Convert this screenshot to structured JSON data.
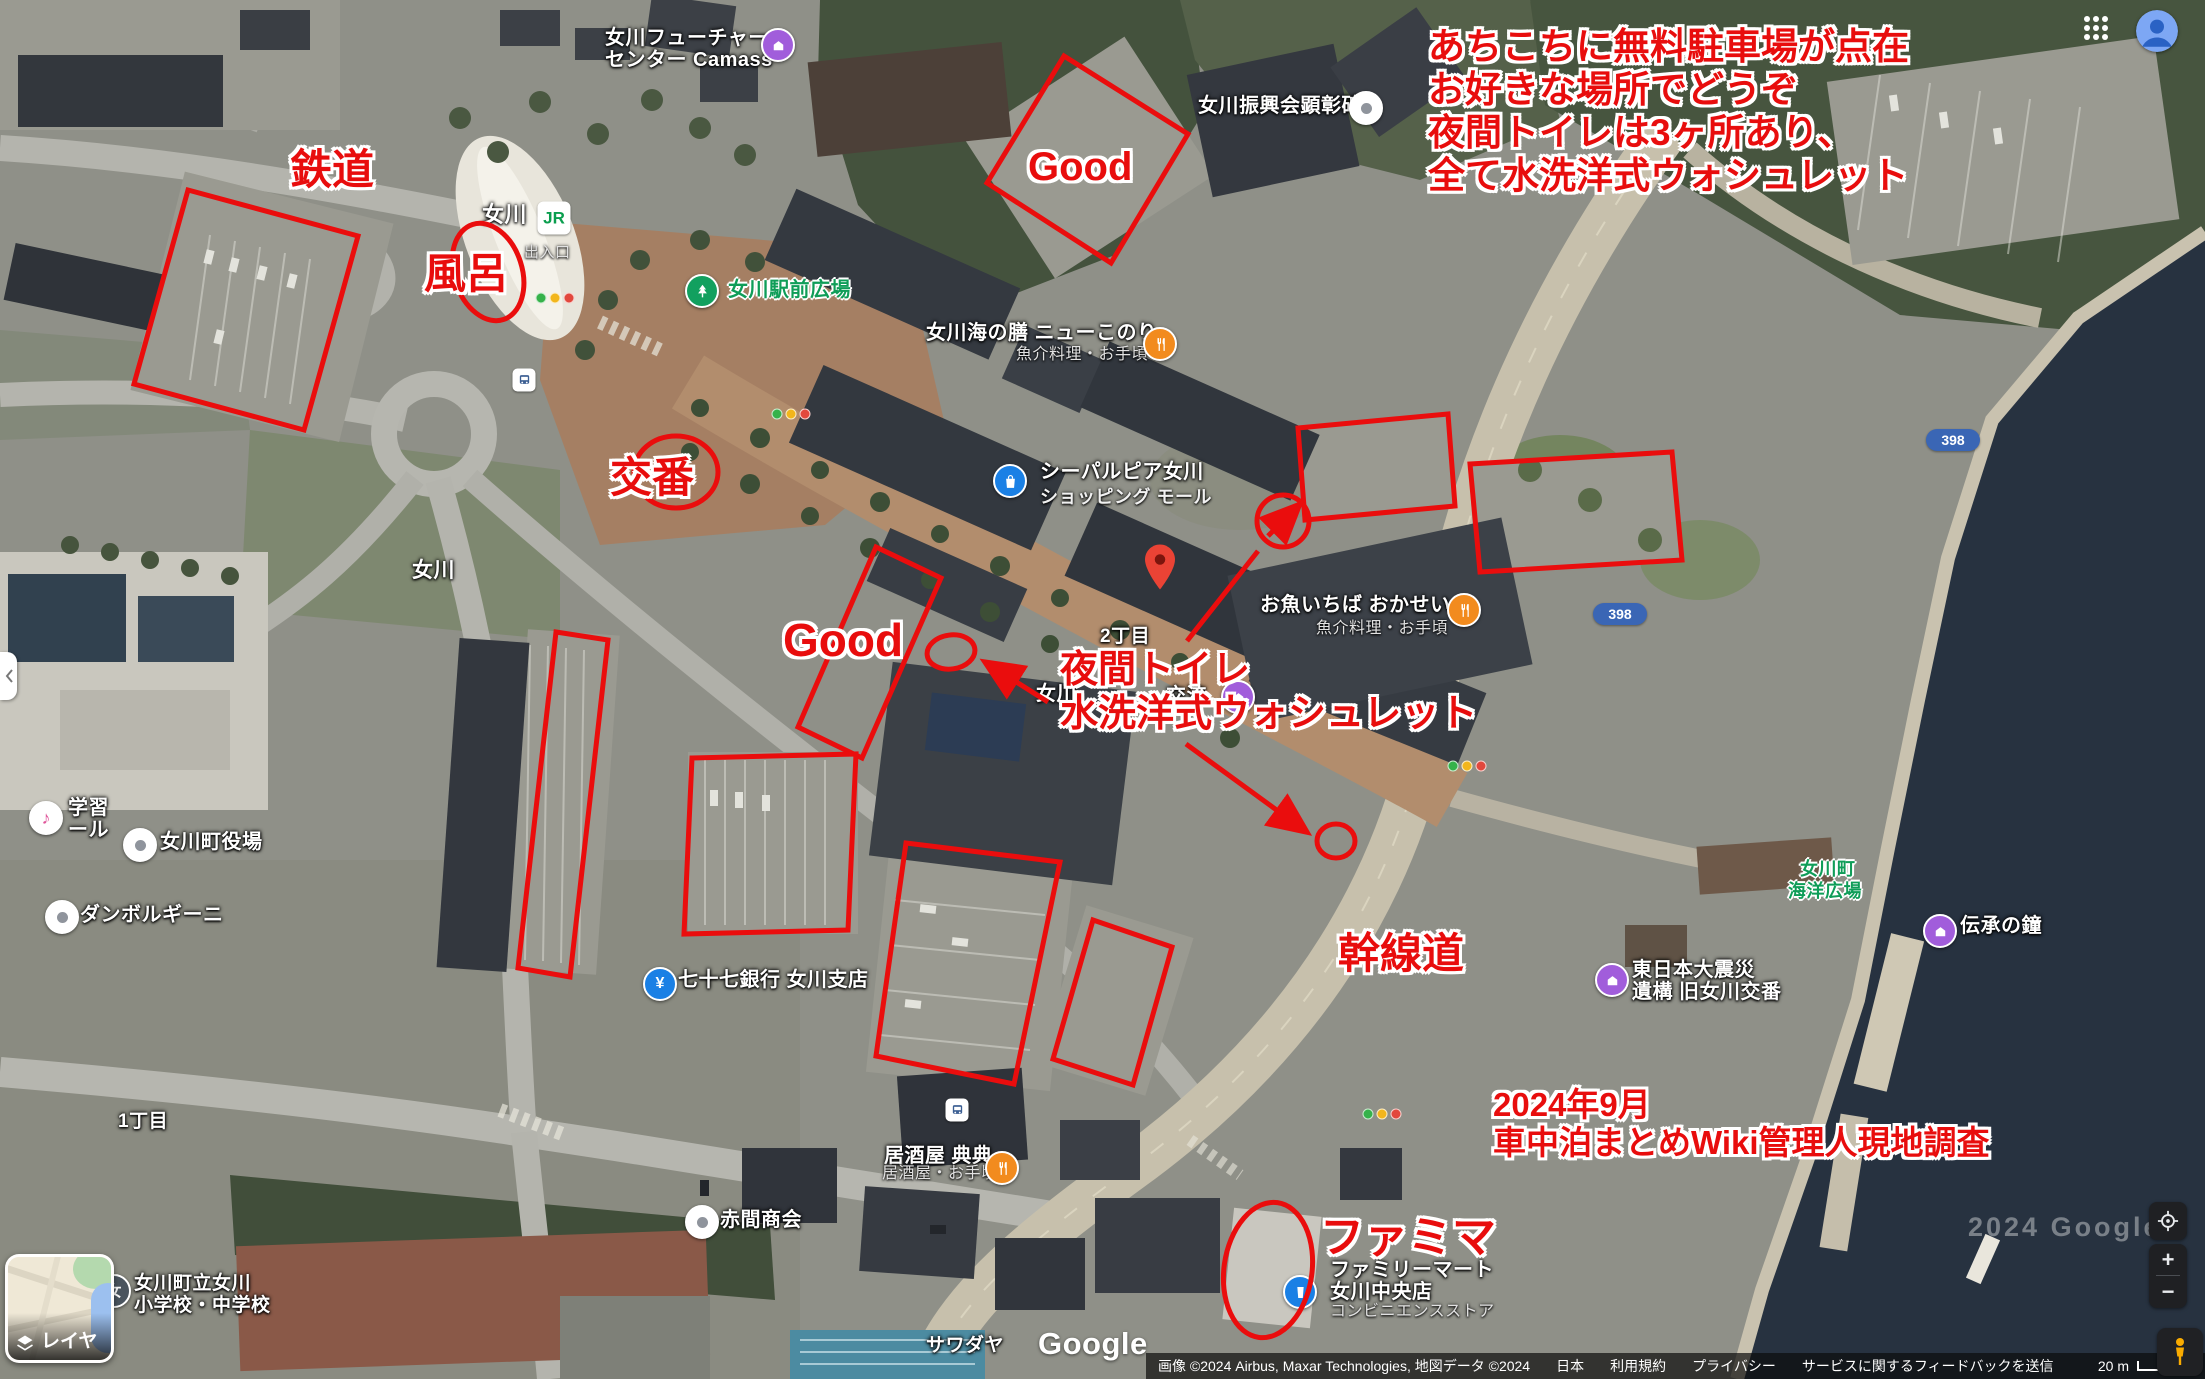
{
  "ui": {
    "layers_button": {
      "label": "レイヤ"
    },
    "controls": {
      "zoom_in": "+",
      "zoom_out": "−"
    },
    "google_logo": "Google",
    "watermark": "2024 Google",
    "attribution": {
      "imagery": "画像 ©2024 Airbus, Maxar Technologies, 地図データ ©2024",
      "links": [
        "日本",
        "利用規約",
        "プライバシー",
        "サービスに関するフィードバックを送信"
      ],
      "scale": "20 m"
    }
  },
  "map": {
    "labels": [
      {
        "t": "女川フューチャー",
        "x": 605,
        "y": 28,
        "c": "w",
        "n": "label-onagawa-future-center"
      },
      {
        "t": "センター Camass",
        "x": 605,
        "y": 50,
        "c": "w",
        "n": "label-onagawa-future-center-2"
      },
      {
        "t": "女川振興会顕彰碑",
        "x": 1198,
        "y": 96,
        "c": "w",
        "n": "label-shinkokai-monument"
      },
      {
        "t": "女川",
        "x": 482,
        "y": 203,
        "c": "w",
        "z": 22,
        "n": "label-onagawa-station"
      },
      {
        "t": "出入口",
        "x": 524,
        "y": 245,
        "c": "sub",
        "z": 15,
        "n": "label-station-entrance"
      },
      {
        "t": "女川駅前広場",
        "x": 728,
        "y": 280,
        "c": "green",
        "n": "label-ekimae-hiroba"
      },
      {
        "t": "女川海の膳 ニューこのり",
        "x": 926,
        "y": 323,
        "c": "w",
        "n": "label-new-konori"
      },
      {
        "t": "魚介料理・お手頃",
        "x": 1016,
        "y": 347,
        "c": "sub",
        "n": "label-new-konori-sub"
      },
      {
        "t": "シーパルピア女川",
        "x": 1040,
        "y": 462,
        "c": "w",
        "n": "label-seapal-pier"
      },
      {
        "t": "ショッピング モール",
        "x": 1040,
        "y": 488,
        "c": "w2",
        "n": "label-seapal-pier-sub"
      },
      {
        "t": "お魚いちば おかせい",
        "x": 1260,
        "y": 595,
        "c": "w",
        "n": "label-okasei"
      },
      {
        "t": "魚介料理・お手頃",
        "x": 1316,
        "y": 621,
        "c": "sub",
        "n": "label-okasei-sub"
      },
      {
        "t": "2丁目",
        "x": 1100,
        "y": 627,
        "c": "w",
        "z": 19,
        "n": "label-2chome"
      },
      {
        "t": "女川",
        "x": 412,
        "y": 560,
        "c": "w",
        "z": 21,
        "n": "label-onagawa-area"
      },
      {
        "t": "1丁目",
        "x": 118,
        "y": 1112,
        "c": "w",
        "z": 19,
        "n": "label-1chome"
      },
      {
        "t": "女川町役場",
        "x": 160,
        "y": 832,
        "c": "w",
        "n": "label-town-hall"
      },
      {
        "t": "ダンボルギーニ",
        "x": 80,
        "y": 905,
        "c": "w",
        "n": "label-danborghini"
      },
      {
        "t": "学習",
        "x": 68,
        "y": 798,
        "c": "w",
        "n": "label-gakushu-partial"
      },
      {
        "t": "ール",
        "x": 68,
        "y": 820,
        "c": "w",
        "n": "label-hall-partial"
      },
      {
        "t": "七十七銀行 女川支店",
        "x": 678,
        "y": 970,
        "c": "w",
        "n": "label-77bank"
      },
      {
        "t": "赤間商会",
        "x": 720,
        "y": 1210,
        "c": "w",
        "n": "label-akama-shokai"
      },
      {
        "t": "居酒屋 典典",
        "x": 884,
        "y": 1146,
        "c": "w",
        "n": "label-izakaya-tenten"
      },
      {
        "t": "居酒屋・お手頃",
        "x": 882,
        "y": 1166,
        "c": "sub",
        "n": "label-izakaya-sub"
      },
      {
        "t": "サワダヤ",
        "x": 926,
        "y": 1336,
        "c": "w",
        "z": 19,
        "n": "label-sawadaya"
      },
      {
        "t": "ファミリーマート",
        "x": 1330,
        "y": 1260,
        "c": "w",
        "n": "label-familymart"
      },
      {
        "t": "女川中央店",
        "x": 1330,
        "y": 1282,
        "c": "w",
        "n": "label-familymart-2"
      },
      {
        "t": "コンビニエンスストア",
        "x": 1330,
        "y": 1304,
        "c": "sub",
        "n": "label-familymart-sub"
      },
      {
        "t": "東日本大震災",
        "x": 1632,
        "y": 960,
        "c": "w",
        "n": "label-shinsai-ikou"
      },
      {
        "t": "遺構 旧女川交番",
        "x": 1632,
        "y": 982,
        "c": "w",
        "n": "label-shinsai-ikou-2"
      },
      {
        "t": "女川町",
        "x": 1800,
        "y": 860,
        "c": "green",
        "z": 18,
        "n": "label-kaiyo-hiroba"
      },
      {
        "t": "海洋広場",
        "x": 1788,
        "y": 882,
        "c": "green",
        "z": 18,
        "n": "label-kaiyo-hiroba-2"
      },
      {
        "t": "伝承の鐘",
        "x": 1960,
        "y": 916,
        "c": "w",
        "n": "label-densho-no-kane"
      },
      {
        "t": "女川",
        "x": 1036,
        "y": 684,
        "c": "w",
        "n": "label-koryukan-partial-1"
      },
      {
        "t": "交流",
        "x": 1166,
        "y": 686,
        "c": "w",
        "n": "label-koryukan-partial-2"
      },
      {
        "t": "女川町立女川",
        "x": 134,
        "y": 1274,
        "c": "w",
        "z": 19,
        "n": "label-school"
      },
      {
        "t": "小学校・中学校",
        "x": 134,
        "y": 1296,
        "c": "w",
        "z": 19,
        "n": "label-school-2"
      }
    ],
    "pins": [
      {
        "k": "purple",
        "x": 778,
        "y": 45,
        "n": "camass-pin"
      },
      {
        "k": "poi",
        "x": 1366,
        "y": 108,
        "n": "monument-pin"
      },
      {
        "k": "jr",
        "t": "JR",
        "x": 554,
        "y": 218,
        "n": "jr-station-logo"
      },
      {
        "k": "park",
        "x": 702,
        "y": 291,
        "n": "ekimae-hiroba-pin"
      },
      {
        "k": "food",
        "x": 1160,
        "y": 344,
        "n": "new-konori-pin"
      },
      {
        "k": "shopping",
        "x": 1010,
        "y": 481,
        "n": "seapal-pier-pin"
      },
      {
        "k": "red-marker",
        "x": 1160,
        "y": 572,
        "n": "dropped-pin"
      },
      {
        "k": "food",
        "x": 1464,
        "y": 610,
        "n": "okasei-pin"
      },
      {
        "k": "purple",
        "x": 1238,
        "y": 697,
        "n": "koryukan-pin"
      },
      {
        "k": "poi",
        "x": 140,
        "y": 845,
        "n": "town-hall-pin"
      },
      {
        "k": "music",
        "t": "♪",
        "x": 46,
        "y": 818,
        "n": "hall-pin"
      },
      {
        "k": "poi",
        "x": 62,
        "y": 917,
        "n": "danborghini-pin"
      },
      {
        "k": "bank",
        "t": "¥",
        "x": 660,
        "y": 984,
        "n": "77bank-pin"
      },
      {
        "k": "poi",
        "x": 702,
        "y": 1222,
        "n": "akama-pin"
      },
      {
        "k": "food",
        "x": 1002,
        "y": 1168,
        "n": "tenten-pin"
      },
      {
        "k": "conv",
        "x": 1300,
        "y": 1292,
        "n": "familymart-pin"
      },
      {
        "k": "school",
        "t": "女",
        "x": 114,
        "y": 1291,
        "n": "school-pin"
      },
      {
        "k": "purple",
        "x": 1612,
        "y": 980,
        "n": "ikou-pin"
      },
      {
        "k": "purple",
        "x": 1940,
        "y": 931,
        "n": "bell-pin"
      },
      {
        "k": "bus",
        "x": 524,
        "y": 380,
        "n": "bus-stop-pin"
      },
      {
        "k": "bus",
        "x": 957,
        "y": 1110,
        "n": "bus-stop-pin-2"
      },
      {
        "k": "traffic",
        "x": 791,
        "y": 414,
        "n": "traffic-light"
      },
      {
        "k": "traffic",
        "x": 1467,
        "y": 766,
        "n": "traffic-light-2"
      },
      {
        "k": "traffic",
        "x": 1382,
        "y": 1114,
        "n": "traffic-light-3"
      },
      {
        "k": "traffic",
        "x": 555,
        "y": 298,
        "n": "traffic-light-4"
      }
    ],
    "badges": [
      {
        "t": "398",
        "x": 1953,
        "y": 440,
        "n": "route-398-badge"
      },
      {
        "t": "398",
        "x": 1620,
        "y": 614,
        "n": "route-398-badge-2"
      }
    ]
  },
  "annotations": {
    "texts": [
      {
        "n": "note-parking-info",
        "lines": [
          "あちこちに無料駐車場が点在",
          "お好きな場所でどうぞ",
          "夜間トイレは3ヶ所あり、",
          "全て水洗洋式ウォシュレット"
        ],
        "x": 1428,
        "y": 26,
        "size": 37
      },
      {
        "n": "note-tetsudo",
        "lines": [
          "鉄道"
        ],
        "x": 290,
        "y": 146,
        "size": 42
      },
      {
        "n": "note-furo",
        "lines": [
          "風呂"
        ],
        "x": 424,
        "y": 250,
        "size": 42
      },
      {
        "n": "note-koban",
        "lines": [
          "交番"
        ],
        "x": 610,
        "y": 454,
        "size": 42
      },
      {
        "n": "note-good-1",
        "lines": [
          "Good"
        ],
        "x": 1028,
        "y": 144,
        "size": 40
      },
      {
        "n": "note-good-2",
        "lines": [
          "Good"
        ],
        "x": 783,
        "y": 614,
        "size": 46
      },
      {
        "n": "note-night-toilet",
        "lines": [
          "夜間トイレ",
          "水洗洋式ウォシュレット"
        ],
        "x": 1060,
        "y": 648,
        "size": 38
      },
      {
        "n": "note-kansendo",
        "lines": [
          "幹線道"
        ],
        "x": 1338,
        "y": 930,
        "size": 42
      },
      {
        "n": "note-survey",
        "lines": [
          "2024年9月",
          "車中泊まとめWiki管理人現地調査"
        ],
        "x": 1493,
        "y": 1086,
        "size": 33
      },
      {
        "n": "note-famima",
        "lines": [
          "ファミマ"
        ],
        "x": 1320,
        "y": 1212,
        "size": 44
      }
    ],
    "shapes": [
      {
        "s": "poly",
        "n": "parking-box-tetsudo",
        "p": "188,190 358,236 304,430 134,384"
      },
      {
        "s": "poly",
        "n": "parking-box-good-top",
        "p": "1064,56 1188,134 1111,263 987,183"
      },
      {
        "s": "poly",
        "n": "parking-box-right-1",
        "p": "1298,428 1448,414 1455,506 1305,520"
      },
      {
        "s": "poly",
        "n": "parking-box-right-2",
        "p": "1470,464 1672,452 1682,560 1480,572"
      },
      {
        "s": "poly",
        "n": "parking-box-left-strip",
        "p": "556,632 608,640 570,977 518,968"
      },
      {
        "s": "poly",
        "n": "parking-box-good-center",
        "p": "876,547 941,578 862,758 798,727"
      },
      {
        "s": "poly",
        "n": "parking-box-center-left",
        "p": "692,758 856,754 848,930 684,934"
      },
      {
        "s": "poly",
        "n": "parking-box-center-big",
        "p": "906,843 1060,862 1014,1084 876,1056"
      },
      {
        "s": "poly",
        "n": "parking-box-center-small",
        "p": "1093,920 1172,947 1133,1085 1053,1059"
      },
      {
        "s": "ellipse",
        "n": "bath-circle",
        "cx": 488,
        "cy": 272,
        "rx": 34,
        "ry": 50,
        "rot": -18
      },
      {
        "s": "ellipse",
        "n": "koban-circle",
        "cx": 676,
        "cy": 472,
        "rx": 42,
        "ry": 36,
        "rot": 0
      },
      {
        "s": "ellipse",
        "n": "toilet-circle-1",
        "cx": 951,
        "cy": 652,
        "rx": 24,
        "ry": 17,
        "rot": -8
      },
      {
        "s": "ellipse",
        "n": "toilet-circle-2",
        "cx": 1336,
        "cy": 841,
        "rx": 19,
        "ry": 17,
        "rot": 0
      },
      {
        "s": "ellipse",
        "n": "famima-circle",
        "cx": 1268,
        "cy": 1270,
        "rx": 44,
        "ry": 68,
        "rot": 8
      },
      {
        "s": "arrow",
        "n": "toilet-arrow-1",
        "x1": 1048,
        "y1": 702,
        "x2": 988,
        "y2": 664
      },
      {
        "s": "arrow",
        "n": "toilet-arrow-2",
        "x1": 1186,
        "y1": 744,
        "x2": 1304,
        "y2": 830
      },
      {
        "s": "line",
        "n": "direction-line",
        "x1": 1187,
        "y1": 641,
        "x2": 1258,
        "y2": 551
      },
      {
        "s": "circle",
        "n": "direction-circle",
        "cx": 1283,
        "cy": 521,
        "r": 26
      },
      {
        "s": "arrow",
        "n": "direction-arrow",
        "x1": 1268,
        "y1": 536,
        "x2": 1297,
        "y2": 507
      }
    ]
  }
}
